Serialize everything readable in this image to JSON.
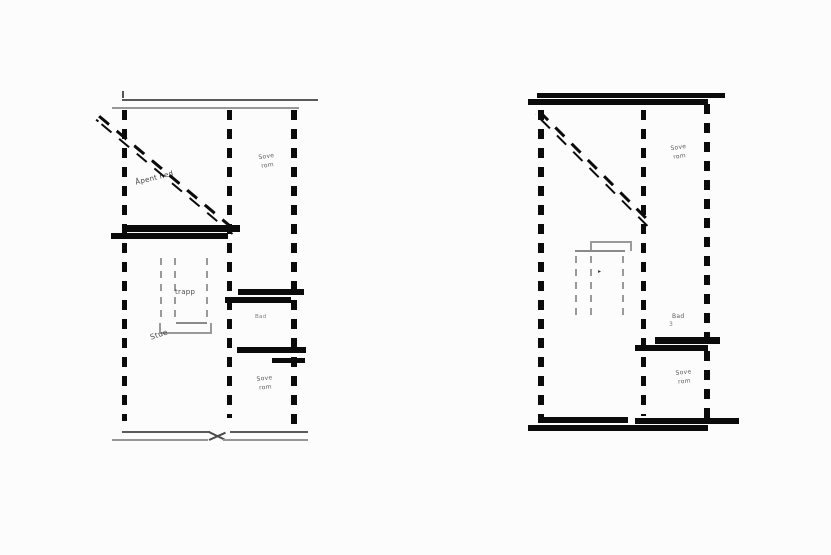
{
  "figure": {
    "background": "#fcfcfc",
    "ink_color": "#0b0b0b",
    "stair_gray": "#999999"
  },
  "left_plan": {
    "open_below_label": "Åpent ned",
    "bedroom_top_label_line1": "Sove",
    "bedroom_top_label_line2": "rom",
    "stairs_label": "trapp",
    "living_room_label": "Stue",
    "bath_label": "Bad",
    "bedroom_bottom_label_line1": "Sove",
    "bedroom_bottom_label_line2": "rom"
  },
  "right_plan": {
    "bedroom_top_label_line1": "Sove",
    "bedroom_top_label_line2": "rom",
    "bath_label": "Bad",
    "bath_note": "3",
    "stairs_arrow": "▸",
    "bedroom_bottom_label_line1": "Sove",
    "bedroom_bottom_label_line2": "rom"
  }
}
